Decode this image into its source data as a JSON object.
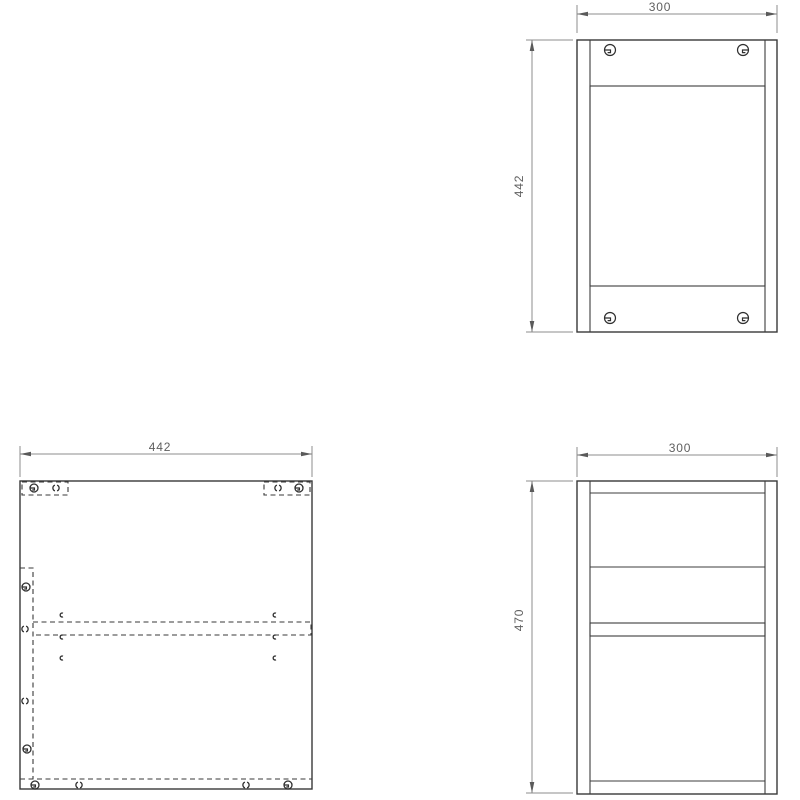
{
  "drawing": {
    "background": "#ffffff",
    "line_color": "#383838",
    "dimension_line_color": "#8c8c8c",
    "dimension_text_color": "#5f5f5f",
    "views": {
      "front": {
        "width_label": "300",
        "height_label": "442"
      },
      "panel": {
        "width_label": "442"
      },
      "side": {
        "width_label": "300",
        "height_label": "470"
      }
    },
    "symbols": {
      "cam": "cam-lock-fitting-icon",
      "hole": "dowel-hole-icon",
      "pilot": "pilot-hole-icon"
    }
  }
}
